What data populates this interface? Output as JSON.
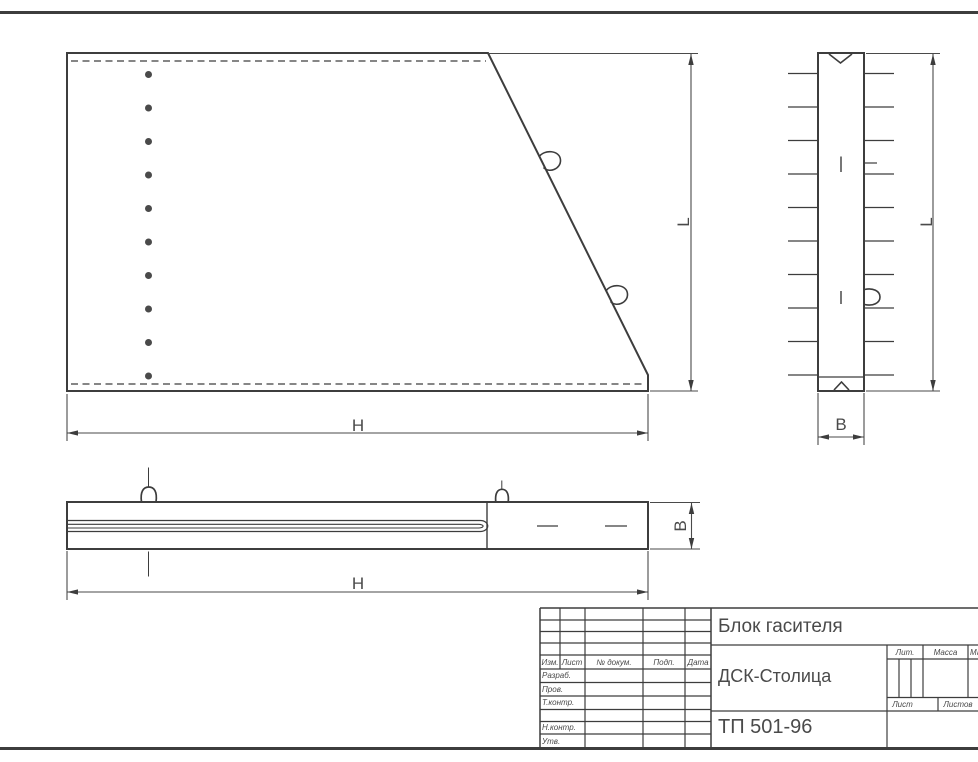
{
  "colors": {
    "line": "#3d3d3d",
    "text": "#4a4a4a",
    "background": "#ffffff"
  },
  "dimension_labels": {
    "height": "H",
    "length": "L",
    "width": "B"
  },
  "title_block": {
    "title": "Блок гасителя",
    "company": "ДСК-Столица",
    "document_number": "ТП 501-96",
    "revision_header": [
      "Изм.",
      "Лист",
      "№ докум.",
      "Подп.",
      "Дата"
    ],
    "signature_rows": [
      "Разраб.",
      "Пров.",
      "Т.контр.",
      "",
      "Н.контр.",
      "Утв."
    ],
    "lit_label": "Лит.",
    "mass_label": "Масса",
    "scale_label": "Масштаб",
    "sheet_label": "Лист",
    "sheets_label": "Листов"
  }
}
